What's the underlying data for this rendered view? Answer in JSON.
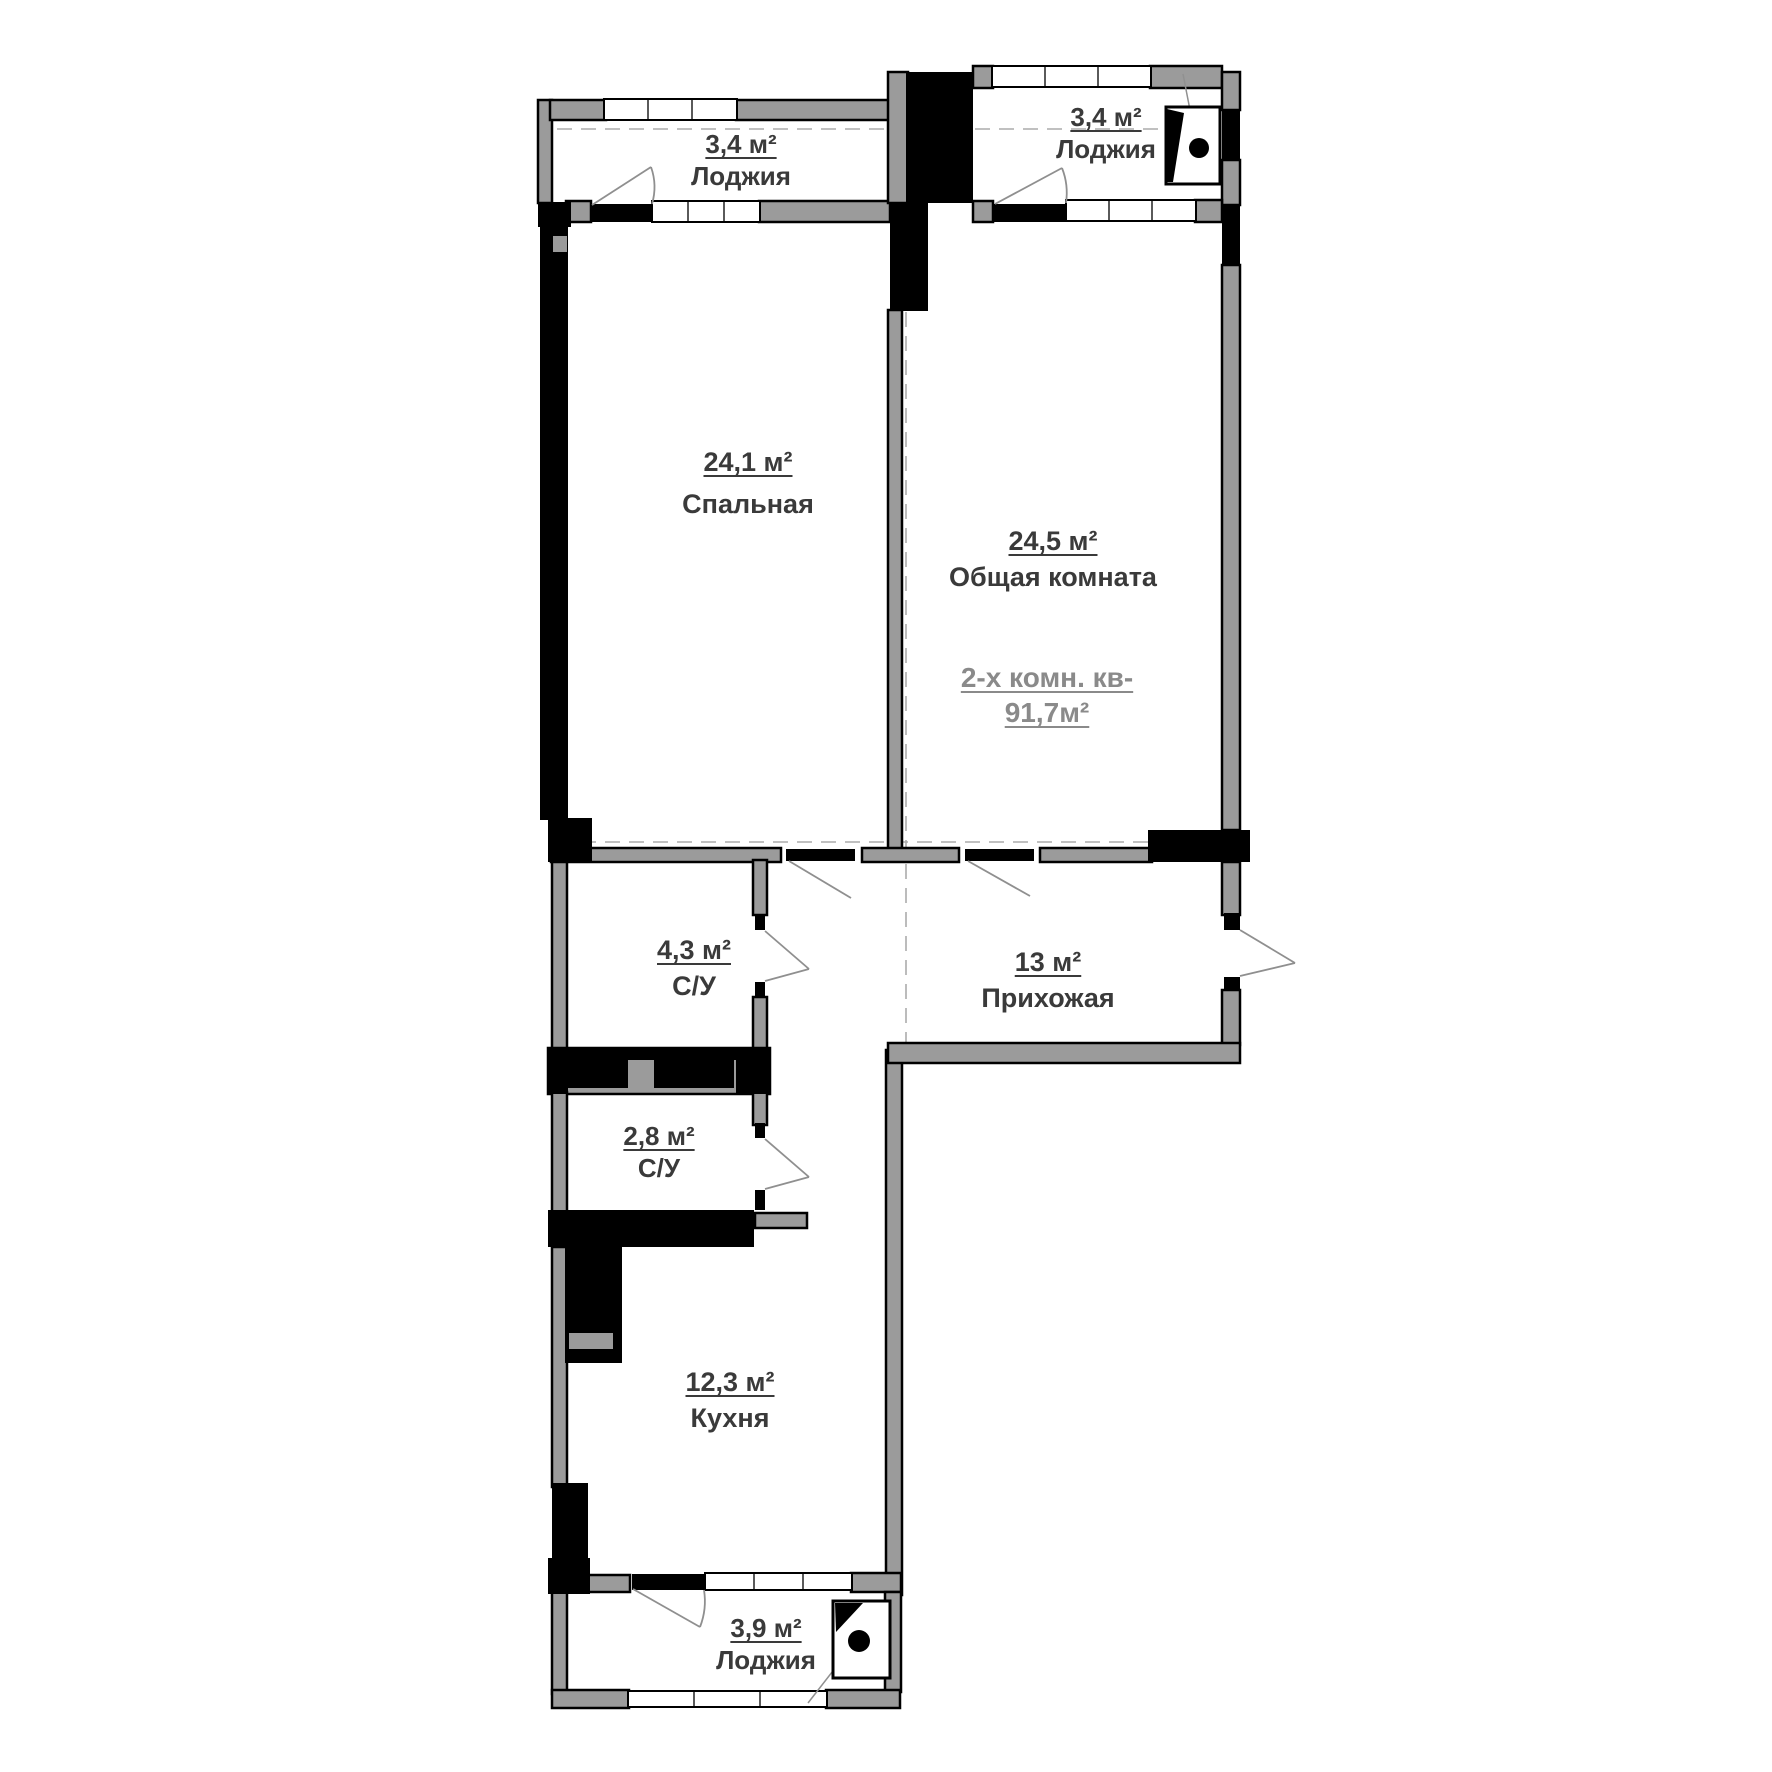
{
  "plan_title": "Floor plan of a two-room apartment",
  "rooms": {
    "loggia_tl": {
      "area": "3,4 м²",
      "name": "Лоджия"
    },
    "loggia_tr": {
      "area": "3,4 м²",
      "name": "Лоджия"
    },
    "bedroom": {
      "area": "24,1 м²",
      "name": "Спальная"
    },
    "living": {
      "area": "24,5 м²",
      "name": "Общая комната"
    },
    "bath_top": {
      "area": "4,3 м²",
      "name": "С/У"
    },
    "hallway": {
      "area": "13 м²",
      "name": "Прихожая"
    },
    "bath_bottom": {
      "area": "2,8 м²",
      "name": "С/У"
    },
    "kitchen": {
      "area": "12,3 м²",
      "name": "Кухня"
    },
    "loggia_bottom": {
      "area": "3,9 м²",
      "name": "Лоджия"
    }
  },
  "summary": {
    "line1": "2-х комн. кв-",
    "line2": "91,7м²"
  },
  "colors": {
    "wall_gray": "#9b9b9b",
    "black": "#000000",
    "text": "#3a3a3a",
    "muted": "#8a8a8a",
    "line": "#ababab",
    "bg": "#ffffff"
  }
}
